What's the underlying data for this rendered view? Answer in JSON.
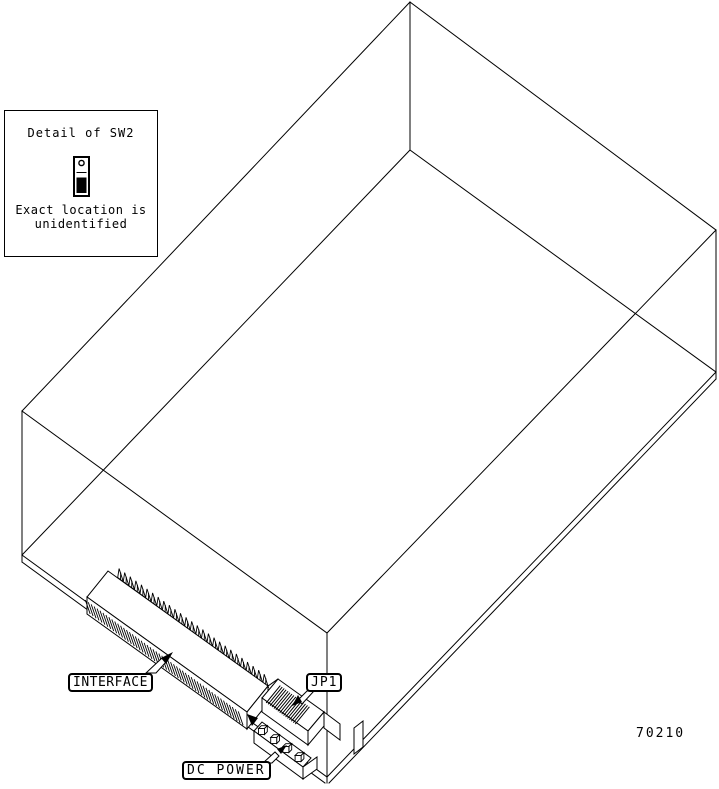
{
  "figure": {
    "number": "70210",
    "ink_color": "#000000",
    "background_color": "#ffffff",
    "subject": "isometric wireframe of disk drive with rear connectors"
  },
  "callouts": {
    "interface": {
      "label": "INTERFACE"
    },
    "jp1": {
      "label": "JP1"
    },
    "dc_power": {
      "label": "DC POWER"
    }
  },
  "detail_box": {
    "title": "Detail of SW2",
    "note_line1": "Exact location is",
    "note_line2": "unidentified",
    "icon": "toggle-switch-icon"
  }
}
